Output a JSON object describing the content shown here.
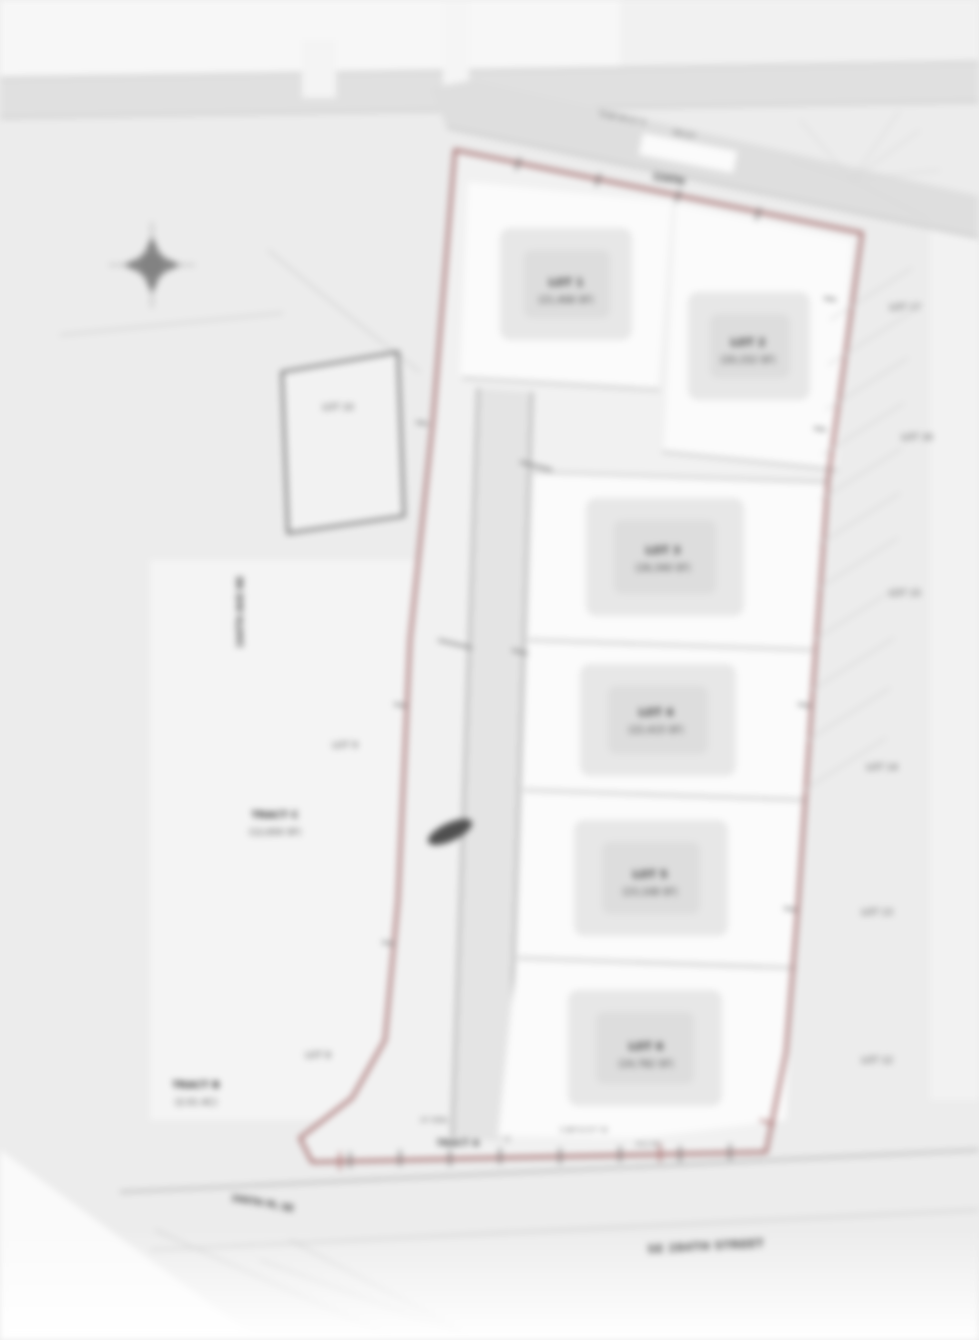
{
  "plan": {
    "colors": {
      "background": "#ececec",
      "boundary_red": "#9c5f5f",
      "road_gray": "#e2e2e2",
      "lot_white": "#fbfbfb",
      "pad_gray": "#dddddd",
      "ink": "#3c3c3c"
    },
    "lots": [
      {
        "name": "LOT 1",
        "area": "(21,406 SF)"
      },
      {
        "name": "LOT 2",
        "area": "(20,152 SF)"
      },
      {
        "name": "LOT 3",
        "area": "(26,340 SF)"
      },
      {
        "name": "LOT 4",
        "area": "(22,415 SF)"
      },
      {
        "name": "LOT 5",
        "area": "(23,108 SF)"
      },
      {
        "name": "LOT 6",
        "area": "(24,782 SF)"
      }
    ],
    "west_parcels": [
      {
        "name": "LOT 10"
      },
      {
        "name": "LOT 9"
      },
      {
        "name": "TRACT C",
        "area": "(12,650 SF)"
      },
      {
        "name": "LOT 8"
      },
      {
        "name": "TRACT B",
        "area": "(2.01 AC)"
      }
    ],
    "east_parcels": [
      "LOT 17",
      "LOT 16",
      "LOT 15",
      "LOT 14",
      "LOT 13",
      "LOT 12"
    ],
    "streets": {
      "north_road": "124TH",
      "west_road": "164TH AVE NE",
      "south_road": "SE 284TH STREET",
      "southwest_road": "166TH PL SE"
    },
    "annotations": {
      "top_bearing": "N 88°40'12\" E",
      "top_distance": "345.67'",
      "bottom_bearing": "S 88°51'07\" W",
      "bottom_distance": "612.44'",
      "bottom_setback": "20' BSBL",
      "bottom_tract": "TRACT A"
    }
  }
}
